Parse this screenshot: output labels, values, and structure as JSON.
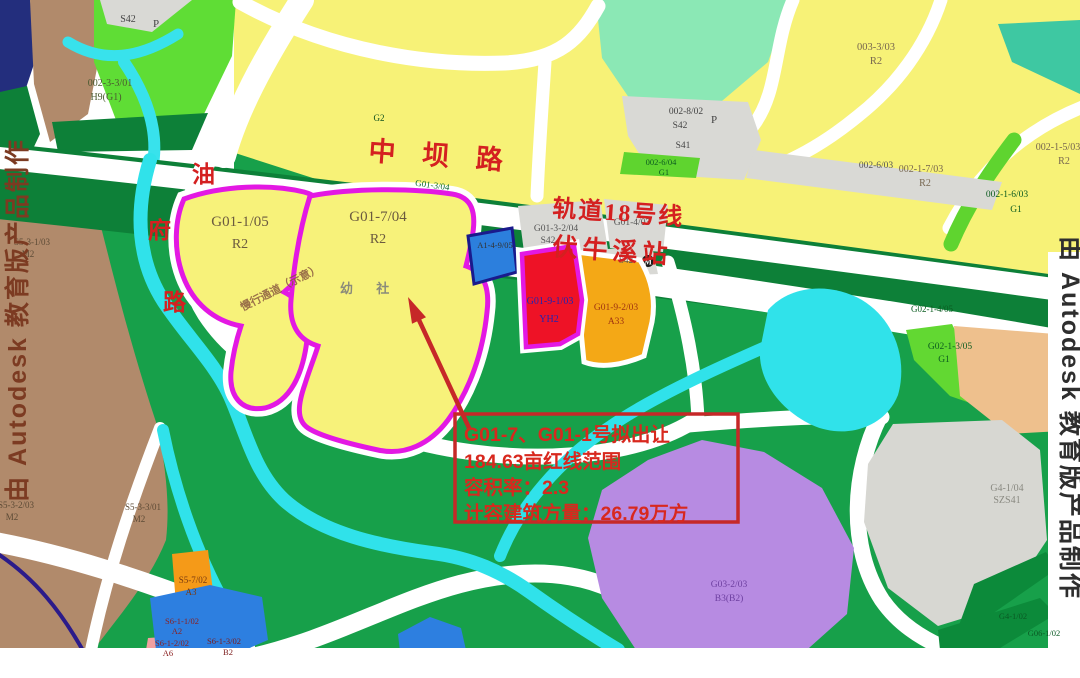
{
  "map_texts": {
    "zhongba_road": "中 坝 路",
    "rail_line": "轨道18号线",
    "station": "伏牛溪站",
    "youfu_road": [
      "油",
      "府",
      "路"
    ],
    "corridor_note": "慢行通道（示意）",
    "kindergarten_mark": "幼 社",
    "station_symbol": "M"
  },
  "annotation_box": {
    "line1": "G01-7、G01-1号拟出让",
    "line2": "184.63亩红线范围",
    "line3": "容积率：2.3",
    "line4": "计容建筑方量：26.79万方"
  },
  "watermarks": {
    "left": "由 Autodesk 教育版产品制作",
    "right": "由 Autodesk 教育版产品制作"
  },
  "parcel_labels": [
    {
      "code": "S42",
      "type": "P"
    },
    {
      "code": "002-3-3/01",
      "type": "H9(G1)"
    },
    {
      "code": "003-3/03",
      "type": "R2"
    },
    {
      "code": "002-8/02",
      "type": "S42",
      "extra": "P"
    },
    {
      "code": "S41"
    },
    {
      "code": "002-6/04",
      "type": "G1"
    },
    {
      "code": "002-6/03"
    },
    {
      "code": "002-1-7/03",
      "type": "R2"
    },
    {
      "code": "002-1-6/03",
      "type": "G1"
    },
    {
      "code": "002-1-5/03",
      "type": "R2"
    },
    {
      "code": "G2"
    },
    {
      "code": "G01-3/04"
    },
    {
      "code": "G01-1/05",
      "type": "R2"
    },
    {
      "code": "G01-7/04",
      "type": "R2"
    },
    {
      "code": "G01-3-2/04",
      "type": "S42"
    },
    {
      "code": "G01-4/03"
    },
    {
      "code": "S42"
    },
    {
      "code": "A1-4-9/05"
    },
    {
      "code": "G01-9-1/03",
      "type": "YH2"
    },
    {
      "code": "G01-9-2/03",
      "type": "A33"
    },
    {
      "code": "G02-1-4/05"
    },
    {
      "code": "G02-1-3/05",
      "type": "G1"
    },
    {
      "code": "G4-1/04",
      "type": "SZS41"
    },
    {
      "code": "G03-2/03",
      "type": "B3(B2)"
    },
    {
      "code": "S5-3-1/03",
      "type": "M2"
    },
    {
      "code": "S5-3-2/03",
      "type": "M2"
    },
    {
      "code": "S5-3-3/01",
      "type": "M2"
    },
    {
      "code": "S5-7/02",
      "type": "A3"
    },
    {
      "code": "S6-1-1/02",
      "type": "A2"
    },
    {
      "code": "S6-1-2/02",
      "type": "A6"
    },
    {
      "code": "S6-1-3/02",
      "type": "B2"
    },
    {
      "code": "G4-1/02"
    },
    {
      "code": "G06-1/02"
    }
  ],
  "colors": {
    "residential_yellow": "#f7f277",
    "green_base": "#17a04a",
    "green_dark_band": "#0d8038",
    "bright_green_g1": "#5fd42f",
    "brown_m2": "#b18a6b",
    "magenta_redline": "#e318e3",
    "river_cyan": "#30e2ea",
    "parcel_red": "#ee1226",
    "parcel_orange": "#f4a816",
    "parcel_purple": "#b78be2",
    "parcel_gray": "#d7d7d2",
    "parcel_blue": "#2c7fdd",
    "parcel_pink": "#f2a0a0",
    "pond_blue": "#2d7fe0",
    "navy_corner": "#232e7d",
    "mint": "#8be8b5",
    "teal": "#3ec8a2",
    "annotation_red": "#c62828",
    "road_text_red": "#d42020"
  }
}
